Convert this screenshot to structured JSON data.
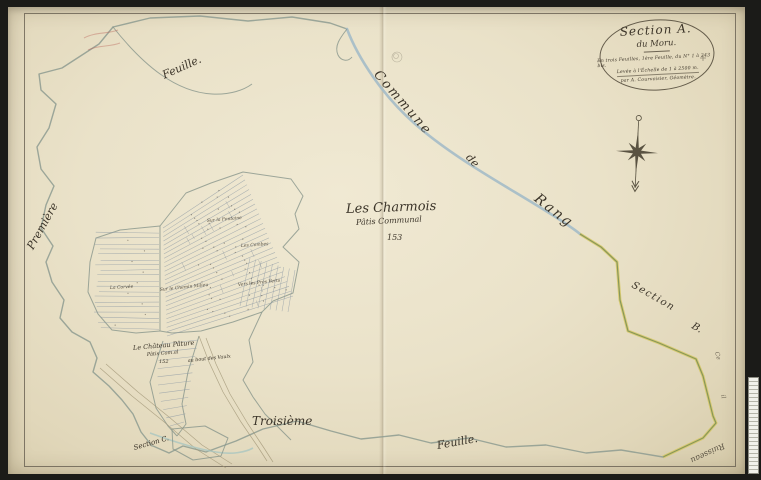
{
  "colors": {
    "paper": "#eae2c9",
    "surround": "#1b1b18",
    "ink": "#3b3429",
    "river_blue": "#a4bbc8",
    "commune_boundary": "#8d9b90",
    "section_boundary_green": "#7e9156",
    "section_boundary_yellow": "#d5c65e"
  },
  "cartouche": {
    "title": "Section A.",
    "subtitle": "du Moru.",
    "line3": "En trois Feuilles, 1ère Feuille, du N° 1 à 243 bis.",
    "line4": "Levée à l'Échelle de 1 à 2500 m.",
    "line5": "par A. Courvoisier, Géomètre."
  },
  "map_labels": [
    {
      "name": "label-feuille-top",
      "text": "Feuille.",
      "x": 163,
      "y": 70,
      "size": 11,
      "rot": -24
    },
    {
      "name": "label-premiere",
      "text": "Première",
      "x": 30,
      "y": 243,
      "size": 11,
      "rot": -61
    },
    {
      "name": "label-commune",
      "text": "Commune",
      "x": 376,
      "y": 66,
      "size": 13,
      "rot": 49,
      "ls": 2
    },
    {
      "name": "label-de",
      "text": "de",
      "x": 468,
      "y": 150,
      "size": 11,
      "rot": 48
    },
    {
      "name": "label-rang",
      "text": "Rang",
      "x": 536,
      "y": 190,
      "size": 14,
      "rot": 38,
      "ls": 2
    },
    {
      "name": "label-les-charmois",
      "text": "Les Charmois",
      "x": 346,
      "y": 203,
      "size": 13,
      "rot": -2
    },
    {
      "name": "label-patis-communal",
      "text": "Pâtis Communal",
      "x": 356,
      "y": 219,
      "size": 8,
      "rot": -3
    },
    {
      "name": "label-parcel-153",
      "text": "153",
      "x": 387,
      "y": 234,
      "size": 8,
      "rot": 0
    },
    {
      "name": "label-chateau",
      "text": "Le Château Pâture",
      "x": 133,
      "y": 345,
      "size": 6.5,
      "rot": -5
    },
    {
      "name": "label-chateau-sub",
      "text": "Pâtis Com.al",
      "x": 147,
      "y": 353,
      "size": 5,
      "rot": -5
    },
    {
      "name": "label-parcel-152",
      "text": "152",
      "x": 159,
      "y": 360,
      "size": 5,
      "rot": 0
    },
    {
      "name": "label-au-bout-des-vaulx",
      "text": "au bout des Vaulx",
      "x": 188,
      "y": 360,
      "size": 4.8,
      "rot": -6
    },
    {
      "name": "label-field-fontaine",
      "text": "Sur la Fontaine",
      "x": 207,
      "y": 220,
      "size": 4.5,
      "rot": -5,
      "op": 0.85
    },
    {
      "name": "label-field-combes",
      "text": "Les Combes",
      "x": 241,
      "y": 245,
      "size": 4.5,
      "rot": -4,
      "op": 0.85
    },
    {
      "name": "label-field-chemin",
      "text": "Sur le Chemin Milieu",
      "x": 160,
      "y": 289,
      "size": 4.5,
      "rot": -6,
      "op": 0.85
    },
    {
      "name": "label-field-pres-verts",
      "text": "Vers les Prés Verts",
      "x": 238,
      "y": 284,
      "size": 4.5,
      "rot": -6,
      "op": 0.85
    },
    {
      "name": "label-field-corvee",
      "text": "La Corvée",
      "x": 110,
      "y": 287,
      "size": 4.5,
      "rot": -3,
      "op": 0.85
    },
    {
      "name": "label-troisieme",
      "text": "Troisième",
      "x": 252,
      "y": 415,
      "size": 12,
      "rot": 0
    },
    {
      "name": "label-feuille-bottom",
      "text": "Feuille.",
      "x": 437,
      "y": 440,
      "size": 11,
      "rot": -10
    },
    {
      "name": "label-section-c",
      "text": "Section C.",
      "x": 134,
      "y": 445,
      "size": 7,
      "rot": -16
    },
    {
      "name": "label-section-right",
      "text": "Section",
      "x": 632,
      "y": 280,
      "size": 10,
      "rot": 30,
      "ls": 1.5
    },
    {
      "name": "label-section-right-letter",
      "text": "B.",
      "x": 692,
      "y": 321,
      "size": 10,
      "rot": 30
    },
    {
      "name": "label-ruisseau",
      "text": "Ruisseau",
      "x": 724,
      "y": 441,
      "size": 8,
      "rot": 155,
      "op": 0.8
    },
    {
      "name": "label-edge-fragment-1",
      "text": "Ce",
      "x": 716,
      "y": 349,
      "size": 6,
      "rot": 75,
      "op": 0.7
    },
    {
      "name": "label-edge-fragment-2",
      "text": "il",
      "x": 722,
      "y": 392,
      "size": 6,
      "rot": 75,
      "op": 0.7
    }
  ]
}
